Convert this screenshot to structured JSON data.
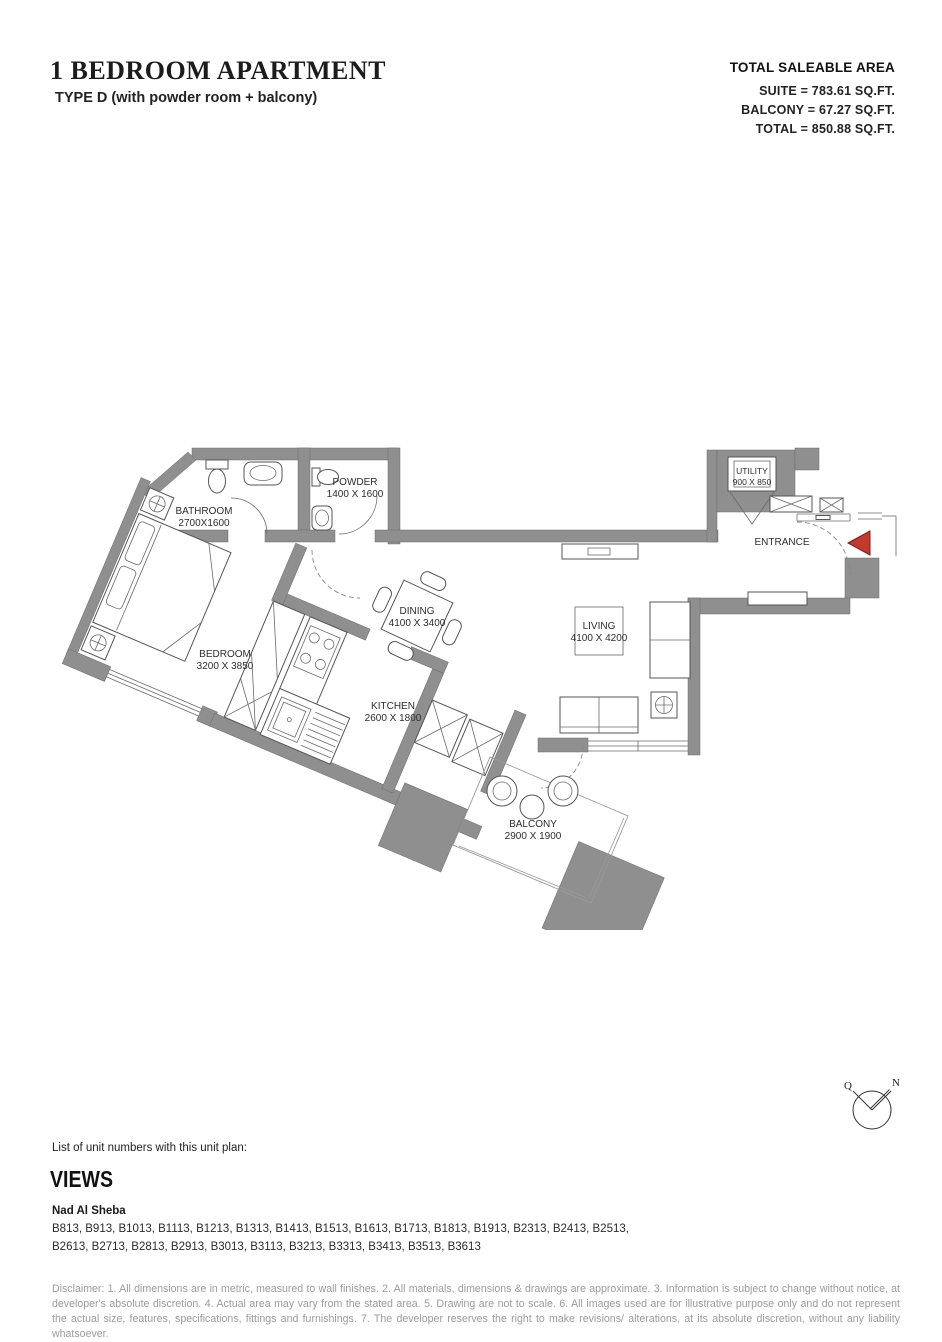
{
  "header": {
    "title": "1 BEDROOM APARTMENT",
    "subtitle": "TYPE D (with powder room + balcony)"
  },
  "area_summary": {
    "title": "TOTAL SALEABLE AREA",
    "lines": [
      "SUITE = 783.61 SQ.FT.",
      "BALCONY = 67.27 SQ.FT.",
      "TOTAL = 850.88 SQ.FT."
    ]
  },
  "rooms": {
    "bathroom": {
      "name": "BATHROOM",
      "dims": "2700X1600"
    },
    "powder": {
      "name": "POWDER",
      "dims": "1400 X 1600"
    },
    "utility": {
      "name": "UTILITY",
      "dims": "900 X 850"
    },
    "entrance": {
      "name": "ENTRANCE"
    },
    "dining": {
      "name": "DINING",
      "dims": "4100 X 3400"
    },
    "living": {
      "name": "LIVING",
      "dims": "4100 X 4200"
    },
    "bedroom": {
      "name": "BEDROOM",
      "dims": "3200 X 3850"
    },
    "kitchen": {
      "name": "KITCHEN",
      "dims": "2600 X 1800"
    },
    "balcony": {
      "name": "BALCONY",
      "dims": "2900 X 1900"
    }
  },
  "compass": {
    "west_label": "Q",
    "north_label": "N"
  },
  "footer": {
    "list_label": "List of unit numbers with this unit plan:",
    "views_title": "VIEWS",
    "area_name": "Nad Al Sheba",
    "unit_numbers": "B813, B913, B1013, B1113, B1213, B1313, B1413, B1513, B1613, B1713, B1813, B1913, B2313, B2413, B2513, B2613, B2713, B2813, B2913, B3013, B3113, B3213, B3313, B3413, B3513, B3613",
    "disclaimer": "Disclaimer: 1. All dimensions are in metric, measured to wall finishes. 2. All materials, dimensions & drawings are approximate. 3. Information is subject to change without notice, at developer's absolute discretion. 4. Actual area may vary from the stated area. 5. Drawing are not to scale. 6. All images used are for illustrative purpose only and do not represent the actual size, features, specifications, fittings and furnishings. 7. The developer reserves the right to make revisions/ alterations, at its absolute discretion, without any liability whatsoever."
  },
  "colors": {
    "wall": "#8f8f8f",
    "entrance_arrow": "#c13a2b",
    "disclaimer_text": "#9b9b9b"
  }
}
